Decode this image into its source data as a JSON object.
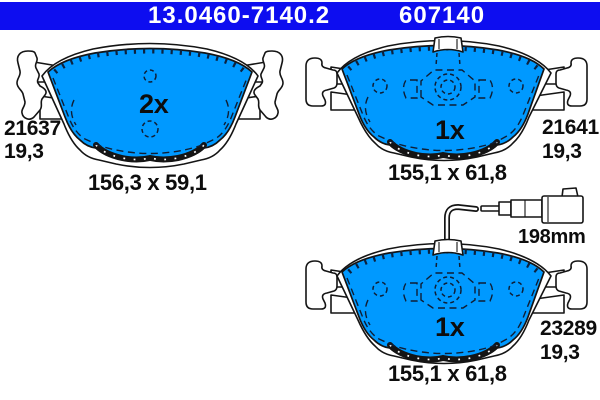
{
  "header": {
    "part_number": "13.0460-7140.2",
    "ean_number": "607140"
  },
  "colors": {
    "header_blue": "#0d0df0",
    "pad_blue": "#0099ff",
    "line": "#141414"
  },
  "pads": {
    "left": {
      "quantity": "2x",
      "wva_number": "21637",
      "thickness_mm": "19,3",
      "dimensions": "156,3 x 59,1"
    },
    "right_top": {
      "quantity": "1x",
      "wva_number": "21641",
      "thickness_mm": "19,3",
      "dimensions": "155,1 x 61,8"
    },
    "right_bottom": {
      "quantity": "1x",
      "wva_number": "23289",
      "thickness_mm": "19,3",
      "dimensions": "155,1 x 61,8",
      "sensor_wire_length": "198mm"
    }
  }
}
